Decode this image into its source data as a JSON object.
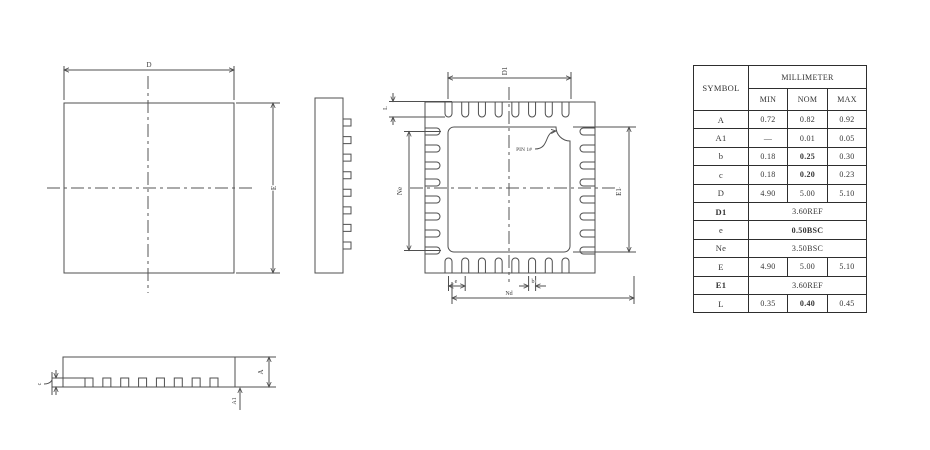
{
  "labels": {
    "d": "D",
    "e_side": "E",
    "d1": "D1",
    "ne": "Ne",
    "e1": "E1",
    "nd": "Nd",
    "pitch_e": "e",
    "b": "b",
    "l": "L",
    "pin1": "PIN 1#",
    "a": "A",
    "a1": "A1",
    "c": "c"
  },
  "table": {
    "header": {
      "symbol": "SYMBOL",
      "unit_group": "MILLIMETER",
      "min": "MIN",
      "nom": "NOM",
      "max": "MAX"
    },
    "rows": [
      {
        "symbol": "A",
        "min": "0.72",
        "nom": "0.82",
        "max": "0.92"
      },
      {
        "symbol": "A1",
        "min": "—",
        "nom": "0.01",
        "max": "0.05"
      },
      {
        "symbol": "b",
        "min": "0.18",
        "nom": "0.25",
        "max": "0.30"
      },
      {
        "symbol": "c",
        "min": "0.18",
        "nom": "0.20",
        "max": "0.23"
      },
      {
        "symbol": "D",
        "min": "4.90",
        "nom": "5.00",
        "max": "5.10"
      },
      {
        "symbol": "D1",
        "span": "3.60REF"
      },
      {
        "symbol": "e",
        "span": "0.50BSC"
      },
      {
        "symbol": "Ne",
        "span": "3.50BSC"
      },
      {
        "symbol": "E",
        "min": "4.90",
        "nom": "5.00",
        "max": "5.10"
      },
      {
        "symbol": "E1",
        "span": "3.60REF"
      },
      {
        "symbol": "L",
        "min": "0.35",
        "nom": "0.40",
        "max": "0.45"
      }
    ]
  },
  "colors": {
    "line": "#4f4f4f",
    "text": "#3d3d3d",
    "background": "#ffffff"
  }
}
